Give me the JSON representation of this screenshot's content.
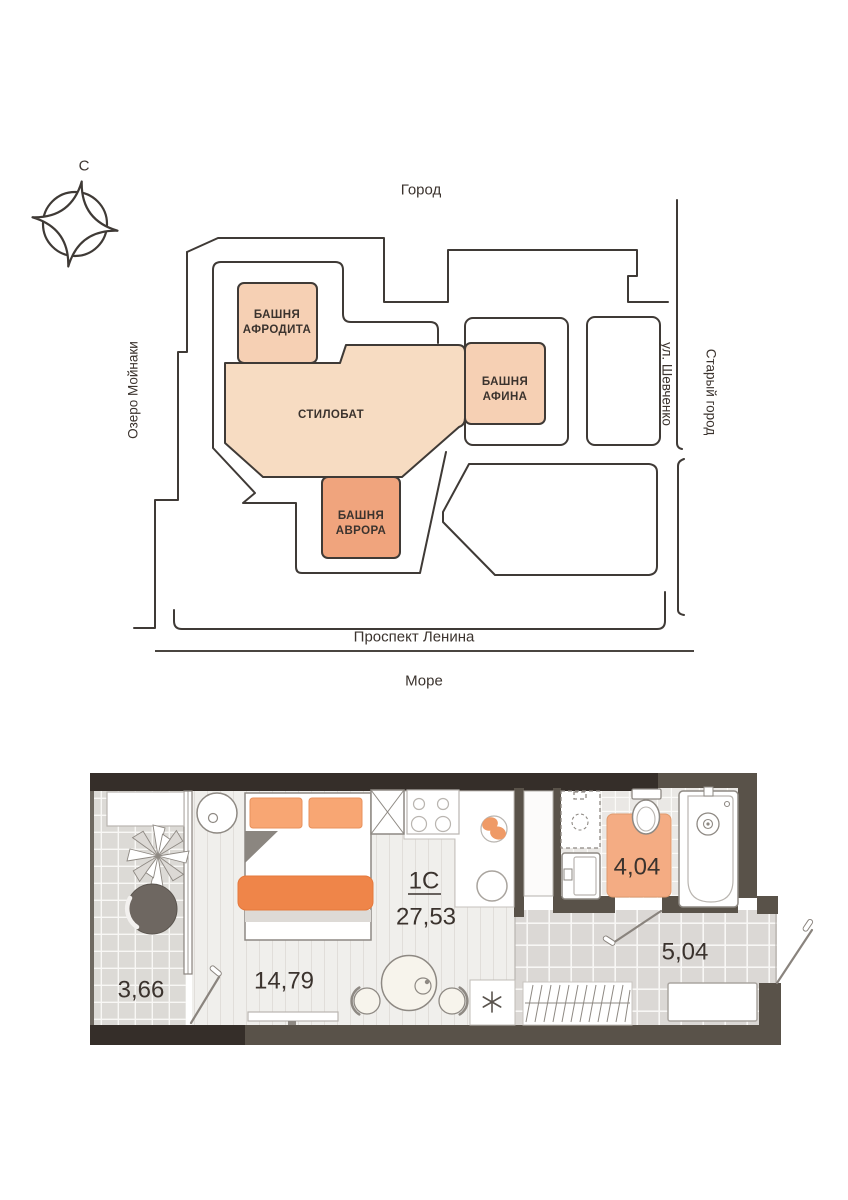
{
  "site_plan": {
    "compass_label": "С",
    "labels": {
      "city": "Город",
      "lake": "Озеро Мойнаки",
      "street_right": "ул. Шевченко",
      "old_town": "Старый город",
      "avenue": "Проспект Ленина",
      "sea": "Море"
    },
    "buildings": [
      {
        "id": "aphrodite",
        "line1": "БАШНЯ",
        "line2": "АФРОДИТА",
        "fill": "#f6d0b4"
      },
      {
        "id": "athena",
        "line1": "БАШНЯ",
        "line2": "АФИНА",
        "fill": "#f6d0b4"
      },
      {
        "id": "aurora",
        "line1": "БАШНЯ",
        "line2": "АВРОРА",
        "fill": "#f0a47d"
      },
      {
        "id": "stylobate",
        "line1": "СТИЛОБАТ",
        "fill": "#f7dcc2"
      }
    ]
  },
  "floor_plan": {
    "apartment_type": "1С",
    "total_area": "27,53",
    "rooms": [
      {
        "name": "living-room",
        "area": "14,79"
      },
      {
        "name": "balcony",
        "area": "3,66"
      },
      {
        "name": "bathroom",
        "area": "4,04"
      },
      {
        "name": "hallway",
        "area": "5,04"
      }
    ],
    "washer_symbol": "✳",
    "colors": {
      "accent_blanket": "#ef8549",
      "pillow": "#f8a673",
      "bath_rug": "#f4ac83",
      "wall_dark": "#352e29",
      "wall_brown": "#595249"
    }
  }
}
